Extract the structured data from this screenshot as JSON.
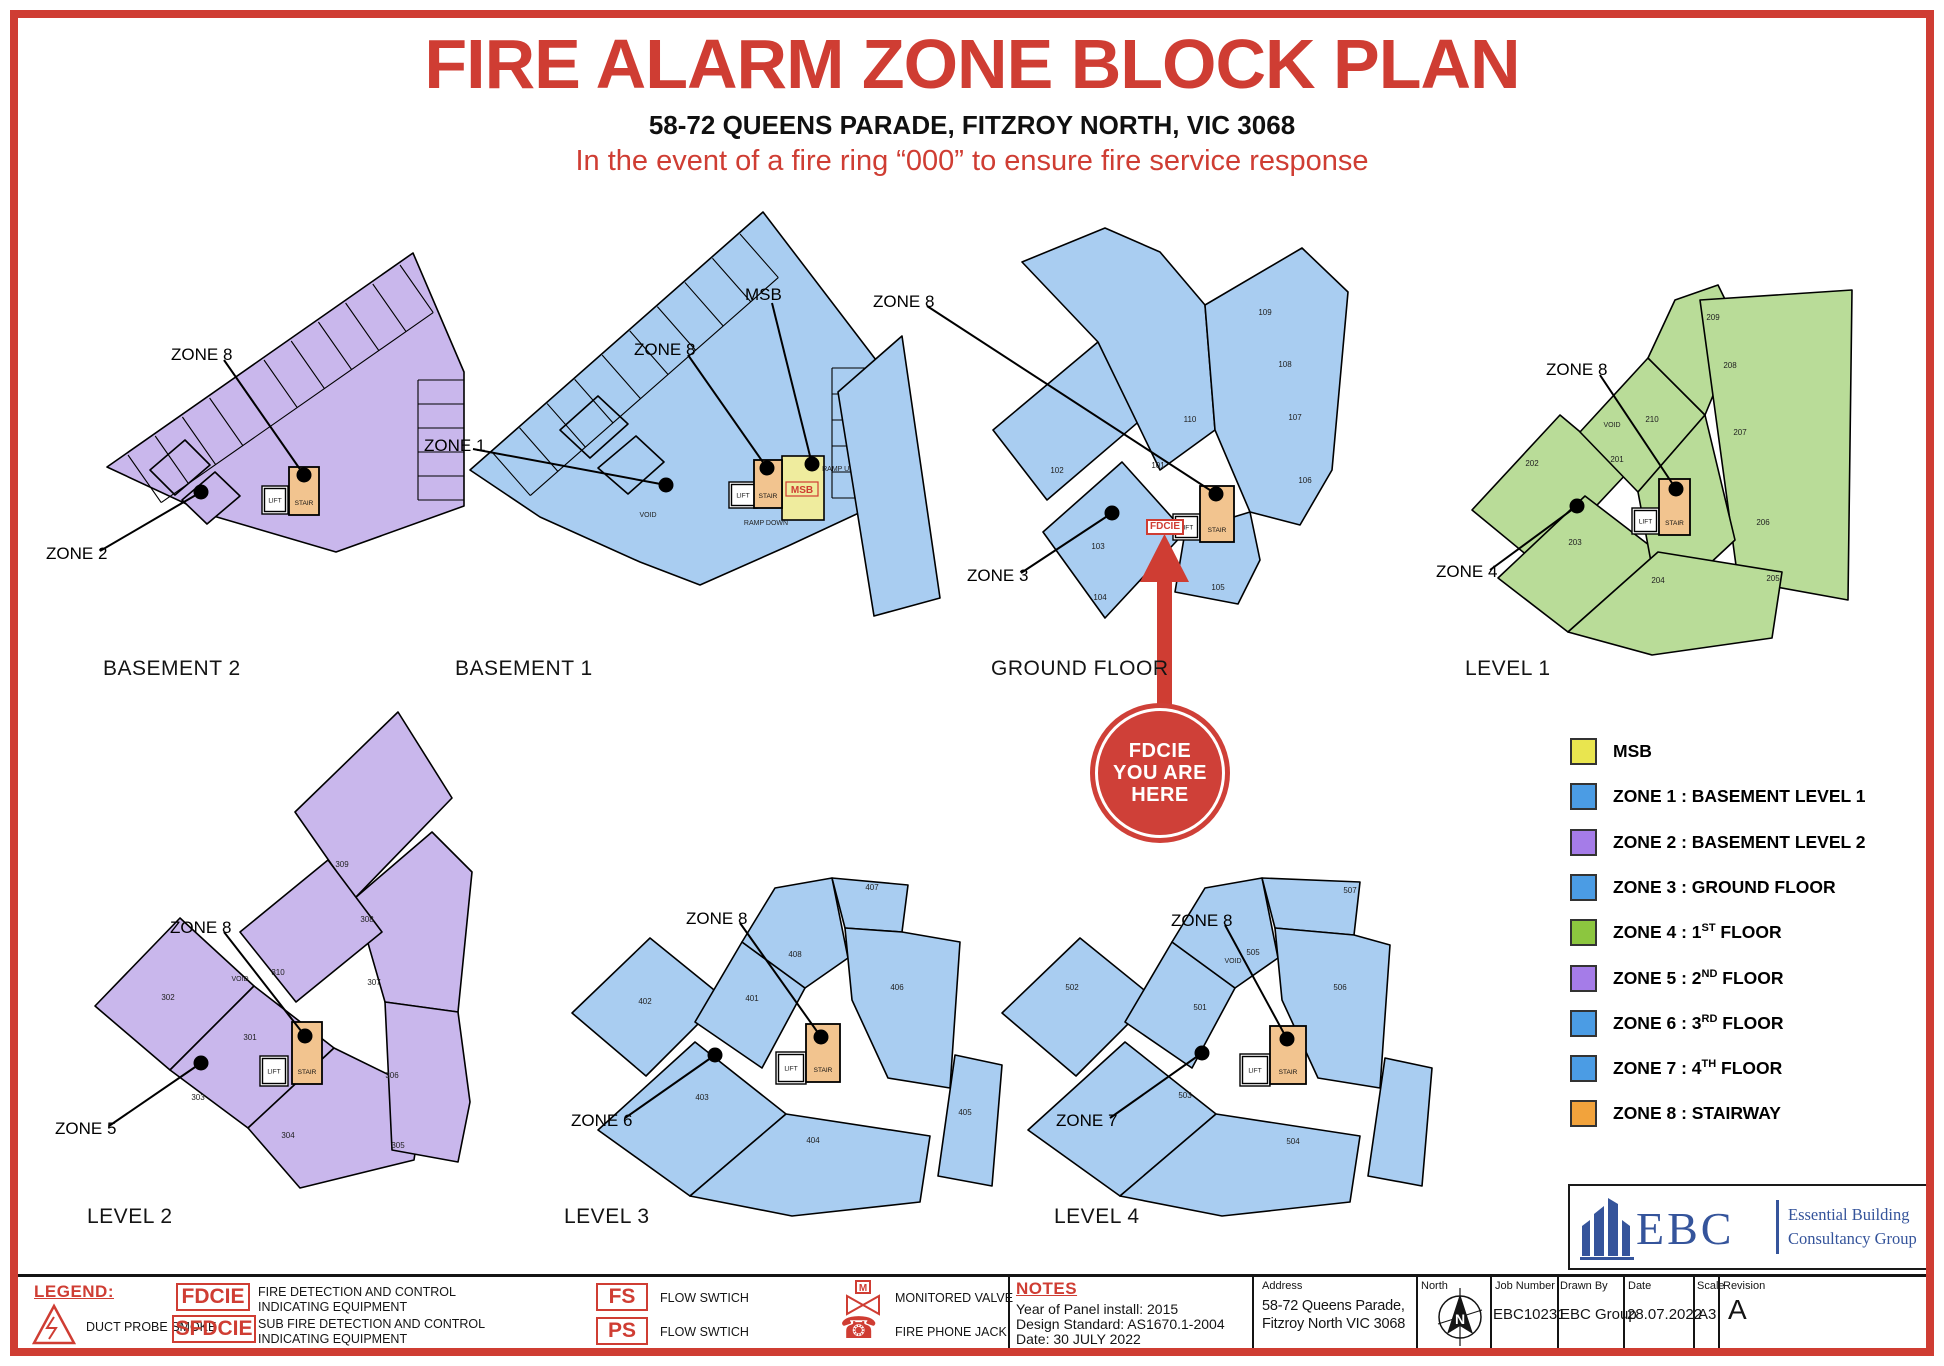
{
  "header": {
    "title": "FIRE ALARM ZONE BLOCK PLAN",
    "subtitle": "58-72 QUEENS PARADE, FITZROY NORTH, VIC 3068",
    "tagline": "In the event of a fire ring “000” to ensure fire service response"
  },
  "shared": {
    "stair": "STAIR",
    "lift": "LIFT"
  },
  "badge": {
    "line1": "FDCIE",
    "line2": "YOU ARE",
    "line3": "HERE"
  },
  "plans": [
    {
      "id": "basement2",
      "caption": "BASEMENT 2",
      "fill": "purple",
      "zones": [
        {
          "label": "ZONE 8"
        },
        {
          "label": "ZONE 2"
        }
      ],
      "rooms": [],
      "texts": []
    },
    {
      "id": "basement1",
      "caption": "BASEMENT 1",
      "fill": "blue",
      "msb": "MSB",
      "zones": [
        {
          "label": "ZONE 8"
        },
        {
          "label": "MSB"
        },
        {
          "label": "ZONE 1"
        }
      ],
      "rooms": [],
      "texts": [
        "VOID",
        "RAMP UP",
        "RAMP DOWN"
      ]
    },
    {
      "id": "ground",
      "caption": "GROUND FLOOR",
      "fill": "blue",
      "fdcie": "FDCIE",
      "zones": [
        {
          "label": "ZONE 8"
        },
        {
          "label": "ZONE 3"
        }
      ],
      "rooms": [
        "101",
        "102",
        "103",
        "104",
        "105",
        "106",
        "107",
        "108",
        "109",
        "110"
      ],
      "texts": []
    },
    {
      "id": "level1",
      "caption": "LEVEL 1",
      "fill": "green",
      "zones": [
        {
          "label": "ZONE 8"
        },
        {
          "label": "ZONE 4"
        }
      ],
      "rooms": [
        "201",
        "202",
        "203",
        "204",
        "205",
        "206",
        "207",
        "208",
        "209",
        "210"
      ],
      "texts": [
        "VOID"
      ]
    },
    {
      "id": "level2",
      "caption": "LEVEL 2",
      "fill": "purple",
      "zones": [
        {
          "label": "ZONE 8"
        },
        {
          "label": "ZONE 5"
        }
      ],
      "rooms": [
        "301",
        "302",
        "303",
        "304",
        "305",
        "306",
        "307",
        "308",
        "309",
        "310"
      ],
      "texts": [
        "VOID"
      ]
    },
    {
      "id": "level3",
      "caption": "LEVEL 3",
      "fill": "blue",
      "zones": [
        {
          "label": "ZONE 8"
        },
        {
          "label": "ZONE 6"
        }
      ],
      "rooms": [
        "401",
        "402",
        "403",
        "404",
        "405",
        "406",
        "407",
        "408"
      ],
      "texts": []
    },
    {
      "id": "level4",
      "caption": "LEVEL 4",
      "fill": "blue",
      "zones": [
        {
          "label": "ZONE 8"
        },
        {
          "label": "ZONE 7"
        }
      ],
      "rooms": [
        "501",
        "502",
        "503",
        "504",
        "505",
        "506",
        "507"
      ],
      "texts": [
        "VOID"
      ]
    }
  ],
  "legend": {
    "items": [
      {
        "color": "#e9e54f",
        "pre": "MSB",
        "sup": "",
        "post": ""
      },
      {
        "color": "#4b9ce4",
        "pre": "ZONE 1 : BASEMENT LEVEL 1",
        "sup": "",
        "post": ""
      },
      {
        "color": "#a57ce8",
        "pre": "ZONE 2 : BASEMENT LEVEL 2",
        "sup": "",
        "post": ""
      },
      {
        "color": "#4b9ce4",
        "pre": "ZONE 3 : GROUND FLOOR",
        "sup": "",
        "post": ""
      },
      {
        "color": "#8cc63f",
        "pre": "ZONE 4 : 1",
        "sup": "ST",
        "post": " FLOOR"
      },
      {
        "color": "#a57ce8",
        "pre": "ZONE 5 : 2",
        "sup": "ND",
        "post": " FLOOR"
      },
      {
        "color": "#4b9ce4",
        "pre": "ZONE 6 : 3",
        "sup": "RD",
        "post": " FLOOR"
      },
      {
        "color": "#4b9ce4",
        "pre": "ZONE 7 : 4",
        "sup": "TH",
        "post": " FLOOR"
      },
      {
        "color": "#f2a33c",
        "pre": "ZONE 8 : STAIRWAY",
        "sup": "",
        "post": ""
      }
    ]
  },
  "logo": {
    "abbr": "EBC",
    "name1": "Essential Building",
    "name2": "Consultancy Group"
  },
  "footer": {
    "legend_title": "LEGEND:",
    "duct_probe_label": "DUCT PROBE SMOKE",
    "fdcie_abbr": "FDCIE",
    "fdcie_desc_1": "FIRE DETECTION AND CONTROL",
    "fdcie_desc_2": "INDICATING EQUIPMENT",
    "sfdcie_abbr": "SFDCIE",
    "sfdcie_desc_1": "SUB FIRE DETECTION AND CONTROL",
    "sfdcie_desc_2": "INDICATING EQUIPMENT",
    "fs_abbr": "FS",
    "fs_label": "FLOW SWTICH",
    "ps_abbr": "PS",
    "ps_label": "FLOW SWTICH",
    "valve_m": "M",
    "valve_label": "MONITORED VALVE",
    "phone_label": "FIRE PHONE JACK",
    "notes_title": "NOTES",
    "note1": "Year of Panel install: 2015",
    "note2": "Design Standard: AS1670.1-2004",
    "note3": "Date: 30 JULY 2022",
    "address_label": "Address",
    "address_1": "58-72 Queens Parade,",
    "address_2": "Fitzroy North VIC 3068",
    "north_label": "North",
    "north_n": "N",
    "job_label": "Job Number",
    "job_value": "EBC10231",
    "drawn_label": "Drawn By",
    "drawn_value": "EBC Group",
    "date_label": "Date",
    "date_value": "28.07.2022",
    "scale_label": "Scale",
    "scale_value": "A3",
    "revision_label": "Revision",
    "revision_value": "A"
  },
  "colors": {
    "page_red": "#cf3d33",
    "plan_blue": "#a9cdf1",
    "plan_purple": "#c9b7ec",
    "plan_green": "#b9dc98",
    "stair_orange": "#f2c48f",
    "msb_fill": "#efec9e",
    "logo_blue": "#35549b"
  }
}
